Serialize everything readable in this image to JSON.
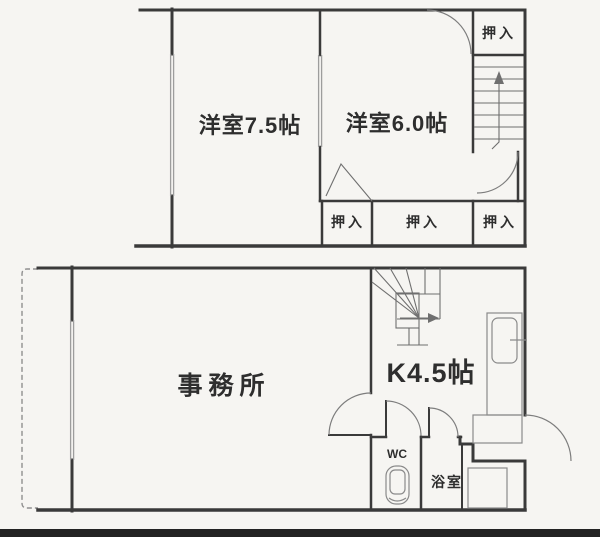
{
  "colors": {
    "wall": "#3a3a3a",
    "background": "#f6f5f2",
    "fixture_line": "#8a8a8a",
    "bottom_band": "#232323"
  },
  "floor2": {
    "room_west": {
      "label": "洋室7.5帖"
    },
    "room_east": {
      "label": "洋室6.0帖"
    },
    "closet_top_right": {
      "label": "押入"
    },
    "closet_bottom_left": {
      "label": "押入"
    },
    "closet_bottom_middle": {
      "label": "押入"
    },
    "closet_bottom_right": {
      "label": "押入"
    }
  },
  "floor1": {
    "office": {
      "label": "事務所"
    },
    "kitchen": {
      "label": "K4.5帖"
    },
    "wc": {
      "label": "WC"
    },
    "bath": {
      "label": "浴室"
    }
  }
}
